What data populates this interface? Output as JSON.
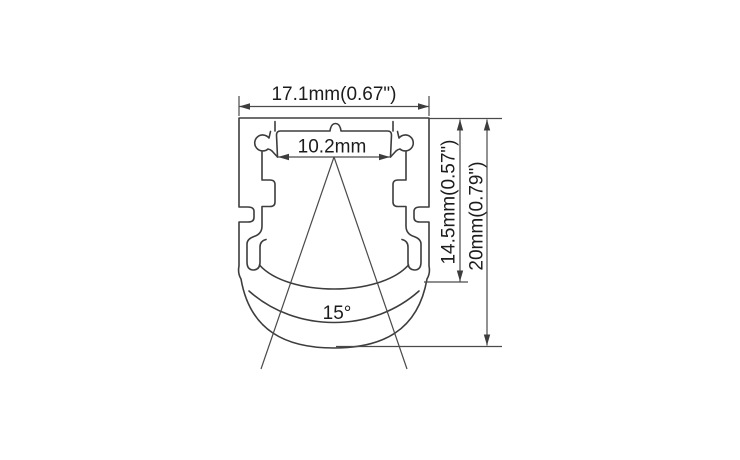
{
  "drawing": {
    "kind": "technical cross-section drawing of an aluminum LED strip profile with lens",
    "background_color": "#ffffff",
    "line_color": "#3d3d3d",
    "text_color": "#1c1c1c",
    "dimensions": {
      "overall_width": "17.1mm(0.67\")",
      "slot_width": "10.2mm",
      "inner_height": "14.5mm(0.57\")",
      "overall_height": "20mm(0.79\")",
      "beam_angle": "15°"
    }
  }
}
